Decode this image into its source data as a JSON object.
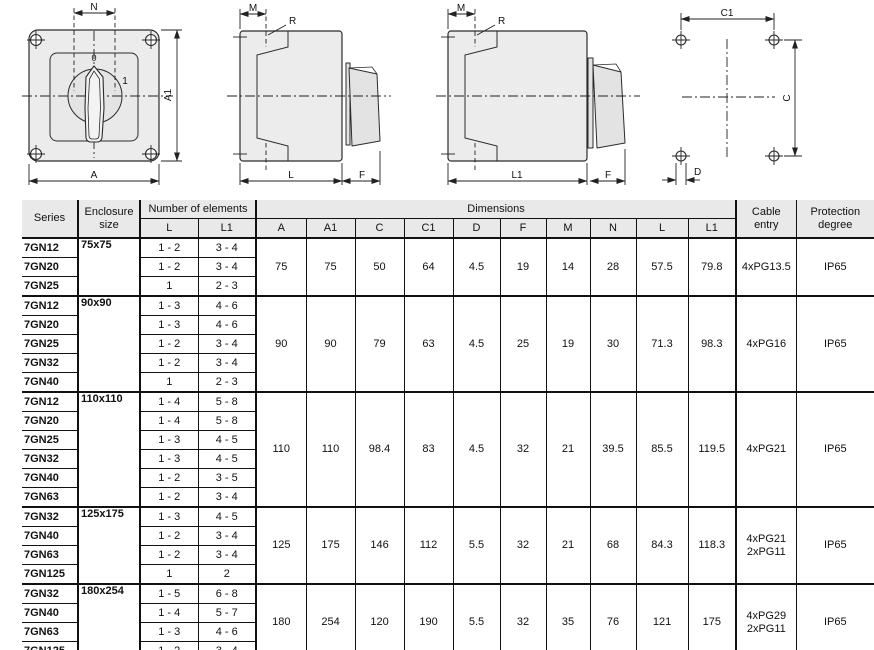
{
  "drawings": {
    "front_view": {
      "n": "N",
      "a1": "A1",
      "a": "A",
      "pos0": "0",
      "pos1": "1"
    },
    "side_l": {
      "m": "M",
      "r": "R",
      "l": "L",
      "f": "F"
    },
    "side_l1": {
      "m": "M",
      "r": "R",
      "l1": "L1",
      "f": "F"
    },
    "drill": {
      "c1": "C1",
      "c": "C",
      "d": "D"
    }
  },
  "table": {
    "headers": {
      "series": "Series",
      "enclosure_size": "Enclosure size",
      "number_of_elements": "Number of elements",
      "dimensions": "Dimensions",
      "elements_sub": [
        "L",
        "L1"
      ],
      "dimensions_sub": [
        "A",
        "A1",
        "C",
        "C1",
        "D",
        "F",
        "M",
        "N",
        "L",
        "L1"
      ],
      "cable_entry": "Cable entry",
      "protection_degree": "Protection degree"
    },
    "groups": [
      {
        "enclosure_size": "75x75",
        "rows": [
          {
            "series": "7GN12",
            "l": "1 - 2",
            "l1": "3 - 4"
          },
          {
            "series": "7GN20",
            "l": "1 - 2",
            "l1": "3 - 4"
          },
          {
            "series": "7GN25",
            "l": "1",
            "l1": "2 - 3"
          }
        ],
        "dims": [
          "75",
          "75",
          "50",
          "64",
          "4.5",
          "19",
          "14",
          "28",
          "57.5",
          "79.8"
        ],
        "cable_entry": [
          "4xPG13.5"
        ],
        "protection": "IP65"
      },
      {
        "enclosure_size": "90x90",
        "rows": [
          {
            "series": "7GN12",
            "l": "1 - 3",
            "l1": "4 - 6"
          },
          {
            "series": "7GN20",
            "l": "1 - 3",
            "l1": "4 - 6"
          },
          {
            "series": "7GN25",
            "l": "1 - 2",
            "l1": "3 - 4"
          },
          {
            "series": "7GN32",
            "l": "1 - 2",
            "l1": "3 - 4"
          },
          {
            "series": "7GN40",
            "l": "1",
            "l1": "2 - 3"
          }
        ],
        "dims": [
          "90",
          "90",
          "79",
          "63",
          "4.5",
          "25",
          "19",
          "30",
          "71.3",
          "98.3"
        ],
        "cable_entry": [
          "4xPG16"
        ],
        "protection": "IP65"
      },
      {
        "enclosure_size": "110x110",
        "rows": [
          {
            "series": "7GN12",
            "l": "1 - 4",
            "l1": "5 - 8"
          },
          {
            "series": "7GN20",
            "l": "1 - 4",
            "l1": "5 - 8"
          },
          {
            "series": "7GN25",
            "l": "1 - 3",
            "l1": "4 - 5"
          },
          {
            "series": "7GN32",
            "l": "1 - 3",
            "l1": "4 - 5"
          },
          {
            "series": "7GN40",
            "l": "1 - 2",
            "l1": "3 - 5"
          },
          {
            "series": "7GN63",
            "l": "1 - 2",
            "l1": "3 - 4"
          }
        ],
        "dims": [
          "110",
          "110",
          "98.4",
          "83",
          "4.5",
          "32",
          "21",
          "39.5",
          "85.5",
          "119.5"
        ],
        "cable_entry": [
          "4xPG21"
        ],
        "protection": "IP65"
      },
      {
        "enclosure_size": "125x175",
        "rows": [
          {
            "series": "7GN32",
            "l": "1 - 3",
            "l1": "4 - 5"
          },
          {
            "series": "7GN40",
            "l": "1 - 2",
            "l1": "3 - 4"
          },
          {
            "series": "7GN63",
            "l": "1 - 2",
            "l1": "3 - 4"
          },
          {
            "series": "7GN125",
            "l": "1",
            "l1": "2"
          }
        ],
        "dims": [
          "125",
          "175",
          "146",
          "112",
          "5.5",
          "32",
          "21",
          "68",
          "84.3",
          "118.3"
        ],
        "cable_entry": [
          "4xPG21",
          "2xPG11"
        ],
        "protection": "IP65"
      },
      {
        "enclosure_size": "180x254",
        "rows": [
          {
            "series": "7GN32",
            "l": "1 - 5",
            "l1": "6 - 8"
          },
          {
            "series": "7GN40",
            "l": "1 - 4",
            "l1": "5 - 7"
          },
          {
            "series": "7GN63",
            "l": "1 - 3",
            "l1": "4 - 6"
          },
          {
            "series": "7GN125",
            "l": "1 - 2",
            "l1": "3 - 4"
          }
        ],
        "dims": [
          "180",
          "254",
          "120",
          "190",
          "5.5",
          "32",
          "35",
          "76",
          "121",
          "175"
        ],
        "cable_entry": [
          "4xPG29",
          "2xPG11"
        ],
        "protection": "IP65"
      }
    ]
  }
}
